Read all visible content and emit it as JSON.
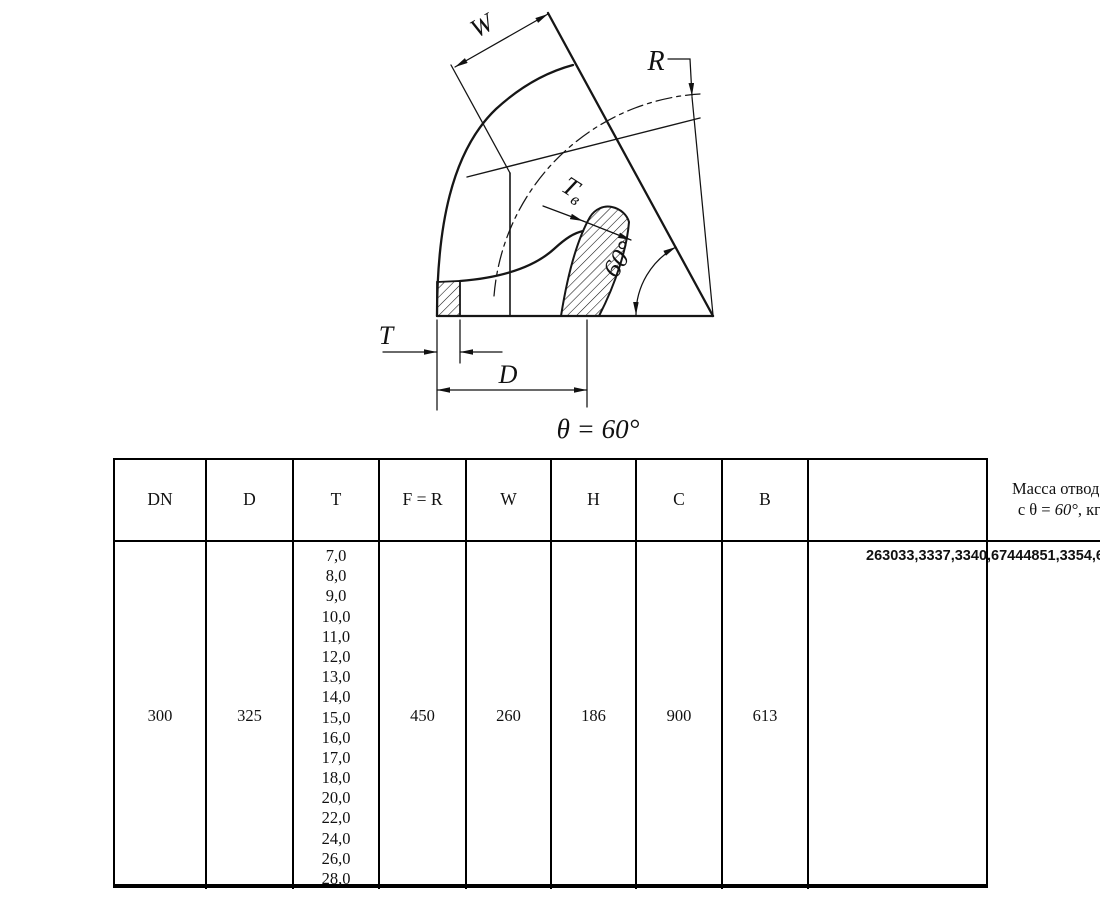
{
  "drawing": {
    "labels": {
      "w": "W",
      "r": "R",
      "tv_main": "Т",
      "tv_sub": "в",
      "angle_arc": "60°",
      "t": "T",
      "d": "D",
      "theta_note": "θ = 60°"
    }
  },
  "table": {
    "headers": {
      "dn": "DN",
      "d": "D",
      "t": "T",
      "fr": "F = R",
      "w": "W",
      "h": "H",
      "c": "C",
      "b": "B",
      "mass_line1": "Масса отвода",
      "mass_prefix": "с θ = ",
      "mass_angle": "60°",
      "mass_suffix": ", кг"
    },
    "row": {
      "dn": "300",
      "d": "325",
      "t_values": [
        "7,0",
        "8,0",
        "9,0",
        "10,0",
        "11,0",
        "12,0",
        "13,0",
        "14,0",
        "15,0",
        "16,0",
        "17,0",
        "18,0",
        "20,0",
        "22,0",
        "24,0",
        "26,0",
        "28,0"
      ],
      "fr": "450",
      "w": "260",
      "h": "186",
      "c": "900",
      "b": "613",
      "mass_values": [
        "26",
        "30",
        "33,33",
        "37,33",
        "40,67",
        "44",
        "48",
        "51,33",
        "54,67",
        "58",
        "61,33",
        "64",
        "71,33",
        "78",
        "86,67",
        "94",
        "100"
      ]
    }
  }
}
